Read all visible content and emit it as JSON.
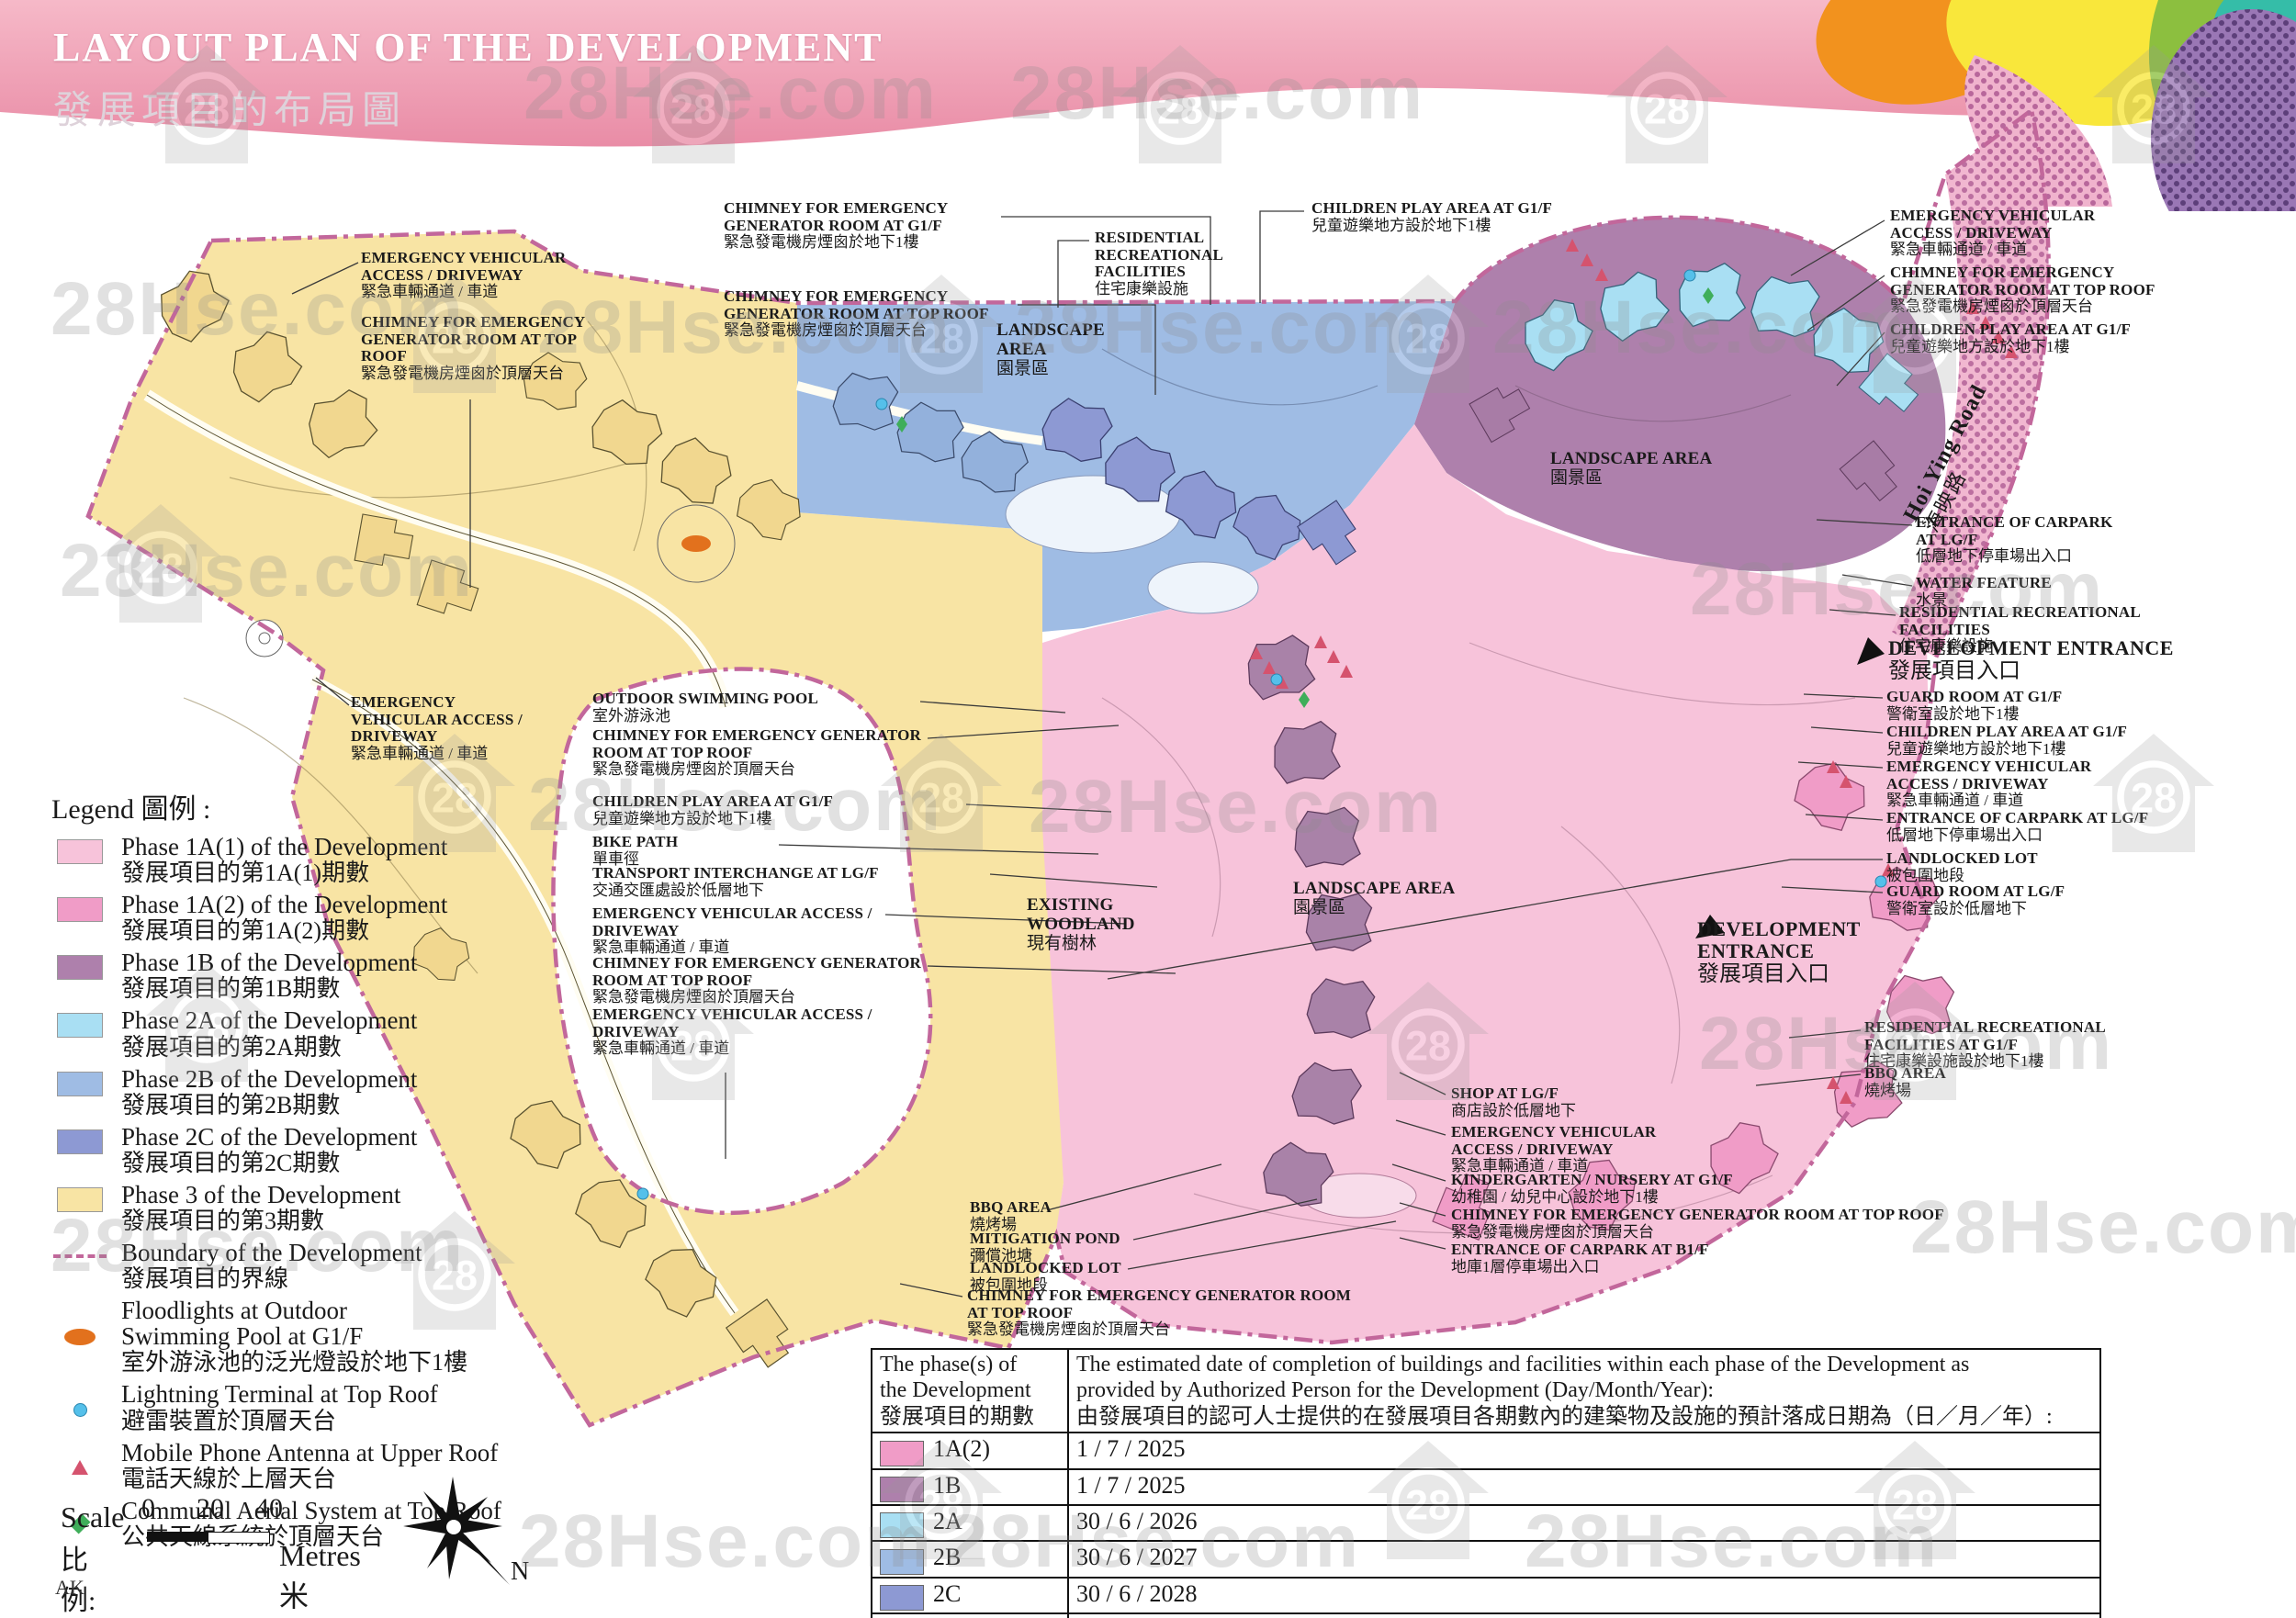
{
  "header": {
    "title_en": "LAYOUT PLAN OF THE DEVELOPMENT",
    "title_zh": "發展項目的布局圖"
  },
  "watermark": {
    "text": "28Hse.com",
    "badge": "28"
  },
  "colors": {
    "phase_1a1": "#F7C3DA",
    "phase_1a2": "#F09CC7",
    "phase_1b": "#AE80AC",
    "phase_2a": "#A9DFF3",
    "phase_2b": "#9FBCE4",
    "phase_2c": "#8D99D3",
    "phase_3": "#F8E4A4",
    "boundary": "#C2679B",
    "floodlight": "#E2711D",
    "lightning": "#55C0EA",
    "antenna": "#D5536E",
    "aerial": "#3FAE5A"
  },
  "labels": {
    "ev_access": {
      "en": "EMERGENCY VEHICULAR ACCESS / DRIVEWAY",
      "zh": "緊急車輛通道 / 車道"
    },
    "chimney_top": {
      "en": "CHIMNEY FOR EMERGENCY GENERATOR ROOM AT TOP ROOF",
      "zh": "緊急發電機房煙囪於頂層天台"
    },
    "chimney_g1f": {
      "en": "CHIMNEY FOR EMERGENCY GENERATOR ROOM AT G1/F",
      "zh": "緊急發電機房煙囪於地下1樓"
    },
    "children": {
      "en": "CHILDREN PLAY AREA AT G1/F",
      "zh": "兒童遊樂地方設於地下1樓"
    },
    "res_rec": {
      "en": "RESIDENTIAL RECREATIONAL FACILITIES",
      "zh": "住宅康樂設施"
    },
    "res_rec_g1f": {
      "en": "RESIDENTIAL RECREATIONAL FACILITIES AT G1/F",
      "zh": "住宅康樂設施設於地下1樓"
    },
    "landscape": {
      "en": "LANDSCAPE AREA",
      "zh": "園景區"
    },
    "dev_entrance": {
      "en": "DEVELOPMENT ENTRANCE",
      "zh": "發展項目入口"
    },
    "guard_g1f": {
      "en": "GUARD ROOM AT G1/F",
      "zh": "警衛室設於地下1樓"
    },
    "guard_lgf": {
      "en": "GUARD ROOM AT LG/F",
      "zh": "警衛室設於低層地下"
    },
    "carpark_lgf": {
      "en": "ENTRANCE OF CARPARK AT LG/F",
      "zh": "低層地下停車場出入口"
    },
    "carpark_b1f": {
      "en": "ENTRANCE OF CARPARK AT B1/F",
      "zh": "地庫1層停車場出入口"
    },
    "landlocked": {
      "en": "LANDLOCKED LOT",
      "zh": "被包圍地段"
    },
    "water": {
      "en": "WATER FEATURE",
      "zh": "水景"
    },
    "pool": {
      "en": "OUTDOOR SWIMMING POOL",
      "zh": "室外游泳池"
    },
    "bike": {
      "en": "BIKE PATH",
      "zh": "單車徑"
    },
    "transport": {
      "en": "TRANSPORT INTERCHANGE AT LG/F",
      "zh": "交通交匯處設於低層地下"
    },
    "woodland": {
      "en": "EXISTING WOODLAND",
      "zh": "現有樹林"
    },
    "bbq": {
      "en": "BBQ AREA",
      "zh": "燒烤場"
    },
    "pond": {
      "en": "MITIGATION POND",
      "zh": "彌償池塘"
    },
    "shop": {
      "en": "SHOP AT LG/F",
      "zh": "商店設於低層地下"
    },
    "kinder": {
      "en": "KINDERGARTEN / NURSERY AT G1/F",
      "zh": "幼稚園 / 幼兒中心設於地下1樓"
    },
    "road": {
      "en": "Hoi Ying Road",
      "zh": "海映路"
    }
  },
  "legend": {
    "title": "Legend 圖例 :",
    "items": [
      {
        "en": "Phase 1A(1) of the Development",
        "zh": "發展項目的第1A(1)期數"
      },
      {
        "en": "Phase 1A(2) of the Development",
        "zh": "發展項目的第1A(2)期數"
      },
      {
        "en": "Phase 1B of the Development",
        "zh": "發展項目的第1B期數"
      },
      {
        "en": "Phase 2A of the Development",
        "zh": "發展項目的第2A期數"
      },
      {
        "en": "Phase 2B of the Development",
        "zh": "發展項目的第2B期數"
      },
      {
        "en": "Phase 2C of the Development",
        "zh": "發展項目的第2C期數"
      },
      {
        "en": "Phase 3 of the Development",
        "zh": "發展項目的第3期數"
      },
      {
        "en": "Boundary of the Development",
        "zh": "發展項目的界線"
      },
      {
        "en": "Floodlights at Outdoor\nSwimming Pool at G1/F",
        "zh": "室外游泳池的泛光燈設於地下1樓"
      },
      {
        "en": "Lightning Terminal at Top Roof",
        "zh": "避雷裝置於頂層天台"
      },
      {
        "en": "Mobile Phone Antenna at Upper Roof",
        "zh": "電話天線於上層天台"
      },
      {
        "en": "Communal Aerial System at Top Roof",
        "zh": "公共天線系統於頂層天台"
      }
    ]
  },
  "scale": {
    "label_en": "Scale",
    "label_zh": "比例:",
    "ticks": [
      "0",
      "20",
      "40"
    ],
    "unit": "Metres 米",
    "north": "N",
    "initials": "AK"
  },
  "table": {
    "col1": "The phase(s) of\nthe Development\n發展項目的期數",
    "col2_en": "The estimated date of completion of buildings and facilities within each phase of the Development as\nprovided by Authorized Person for the Development (Day/Month/Year):",
    "col2_zh": "由發展項目的認可人士提供的在發展項目各期數內的建築物及設施的預計落成日期為（日／月／年）:",
    "rows": [
      {
        "phase": "1A(2)",
        "date": "1 / 7 / 2025"
      },
      {
        "phase": "1B",
        "date": "1 / 7 / 2025"
      },
      {
        "phase": "2A",
        "date": "30 / 6 / 2026"
      },
      {
        "phase": "2B",
        "date": "30 / 6 / 2027"
      },
      {
        "phase": "2C",
        "date": "30 / 6 / 2028"
      },
      {
        "phase": "3",
        "date": "28 / 6 / 2030"
      }
    ]
  }
}
